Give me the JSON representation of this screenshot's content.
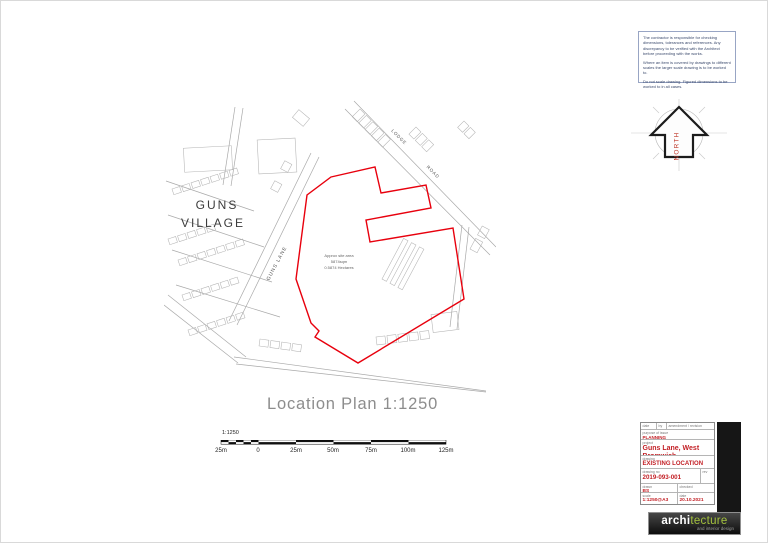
{
  "notes": {
    "paragraphs": [
      "The contractor is responsible for checking dimensions, tolerances and references. Any discrepancy to be verified with the Architect before proceeding with the works.",
      "Where an item is covered by drawings to different scales the larger scale drawing is to be worked to.",
      "Do not scale drawing. Figured dimensions to be worked to in all cases."
    ]
  },
  "north_arrow": {
    "label": "NORTH"
  },
  "map": {
    "village": [
      "GUNS",
      "VILLAGE"
    ],
    "lane": "GUNS LANE",
    "road1": "LODGE",
    "road2": "ROAD",
    "site_area": [
      "Approx site area",
      "5874sqm",
      "0.5874 Hectares"
    ]
  },
  "plan_title": "Location Plan 1:1250",
  "scale_bar": {
    "ratio": "1:1250",
    "ticks": [
      "25m",
      "0",
      "25m",
      "50m",
      "75m",
      "100m",
      "125m"
    ]
  },
  "title_block": {
    "revision_header": {
      "date": "date",
      "by": "by",
      "amendment": "amendment / revision"
    },
    "purpose": {
      "label": "purpose of issue",
      "value": "PLANNING"
    },
    "project": {
      "label": "project",
      "value": "Guns Lane, West Bromwich"
    },
    "drawing": {
      "label": "drawing",
      "value": "EXISTING LOCATION PLAN"
    },
    "drawing_no": {
      "label": "drawing no",
      "value": "2019-093-001"
    },
    "rev": {
      "label": "rev",
      "value": ""
    },
    "drawn": {
      "label": "drawn",
      "value": "BS"
    },
    "checked": {
      "label": "checked",
      "value": ""
    },
    "scale": {
      "label": "scale",
      "value": "1:1250@A3"
    },
    "date": {
      "label": "date",
      "value": "20.10.2021"
    }
  },
  "logo": {
    "brand_left": "archi",
    "brand_right": "tecture",
    "tagline": "and interior design"
  },
  "colors": {
    "site_boundary": "#e8000d",
    "title_accent": "#c32026",
    "logo_green": "#a3c13d",
    "notes_text": "#3b4a6d"
  }
}
